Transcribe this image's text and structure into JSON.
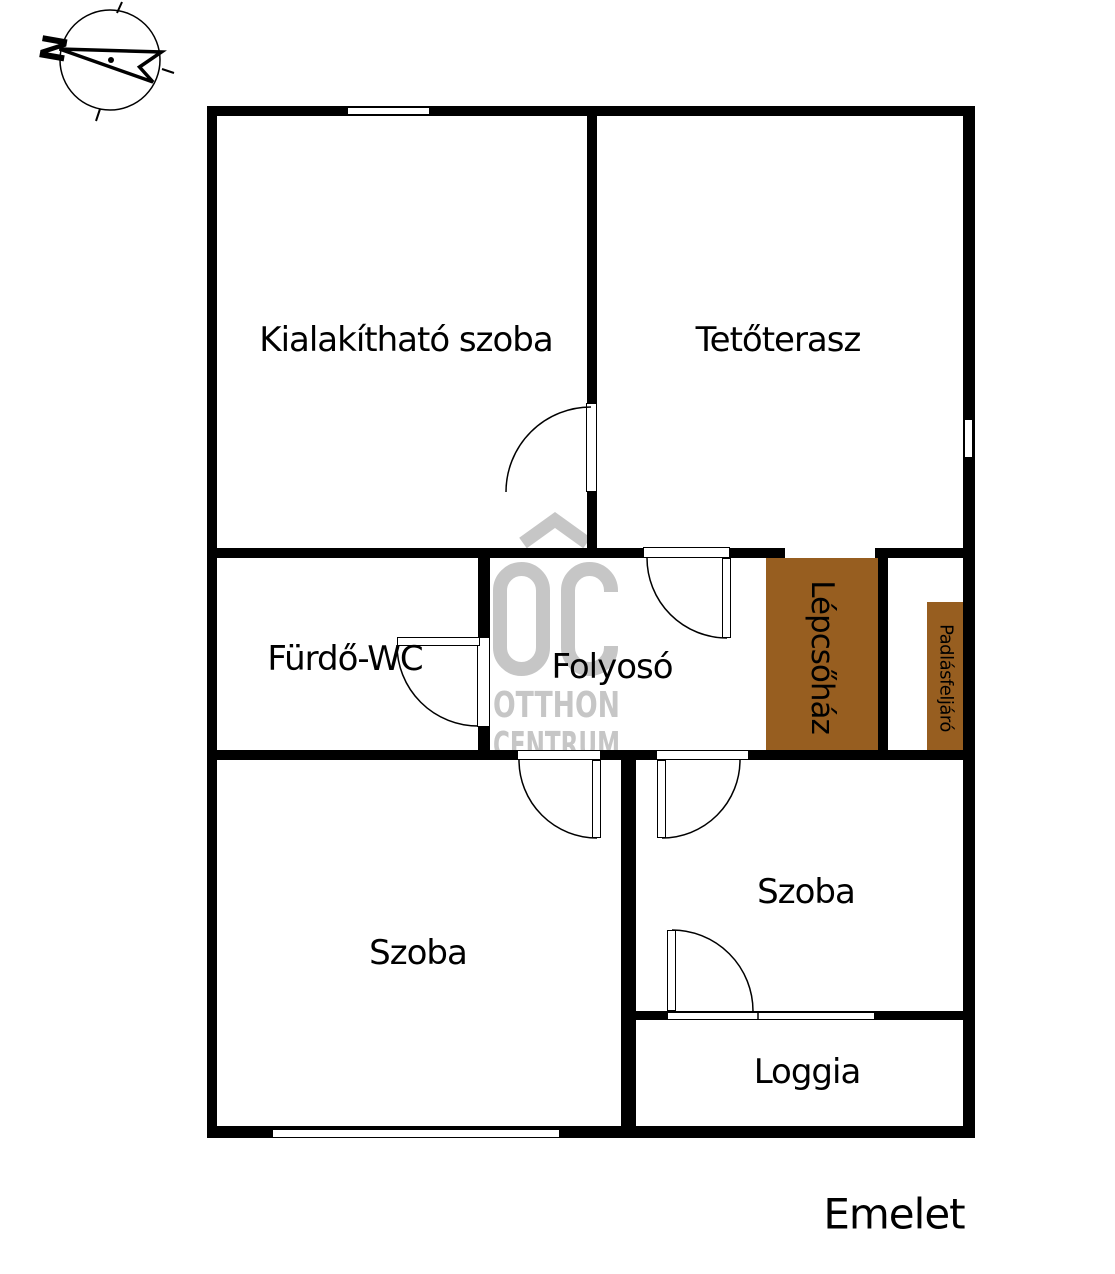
{
  "floor_plan": {
    "floor_label": "Emelet",
    "compass": {
      "north_label": "N"
    },
    "watermark": {
      "logo": "OC",
      "line1": "OTTHON",
      "line2": "CENTRUM"
    },
    "rooms": [
      {
        "id": "kialakithato-szoba",
        "name": "Kialakítható szoba",
        "highlight": false
      },
      {
        "id": "tetoterasz",
        "name": "Tetőterasz",
        "highlight": false
      },
      {
        "id": "furdo-wc",
        "name": "Fürdő-WC",
        "highlight": false
      },
      {
        "id": "folyoso",
        "name": "Folyosó",
        "highlight": false
      },
      {
        "id": "lepcsohaz",
        "name": "Lépcsőház",
        "highlight": true
      },
      {
        "id": "padlasfeljaro",
        "name": "Padlásfeljáró",
        "highlight": true
      },
      {
        "id": "szoba-bal",
        "name": "Szoba",
        "highlight": false
      },
      {
        "id": "szoba-jobb",
        "name": "Szoba",
        "highlight": false
      },
      {
        "id": "loggia",
        "name": "Loggia",
        "highlight": false
      }
    ],
    "colors": {
      "wall": "#000000",
      "highlight_brown": "#975E20",
      "watermark_gray": "#C6C6C6"
    }
  }
}
